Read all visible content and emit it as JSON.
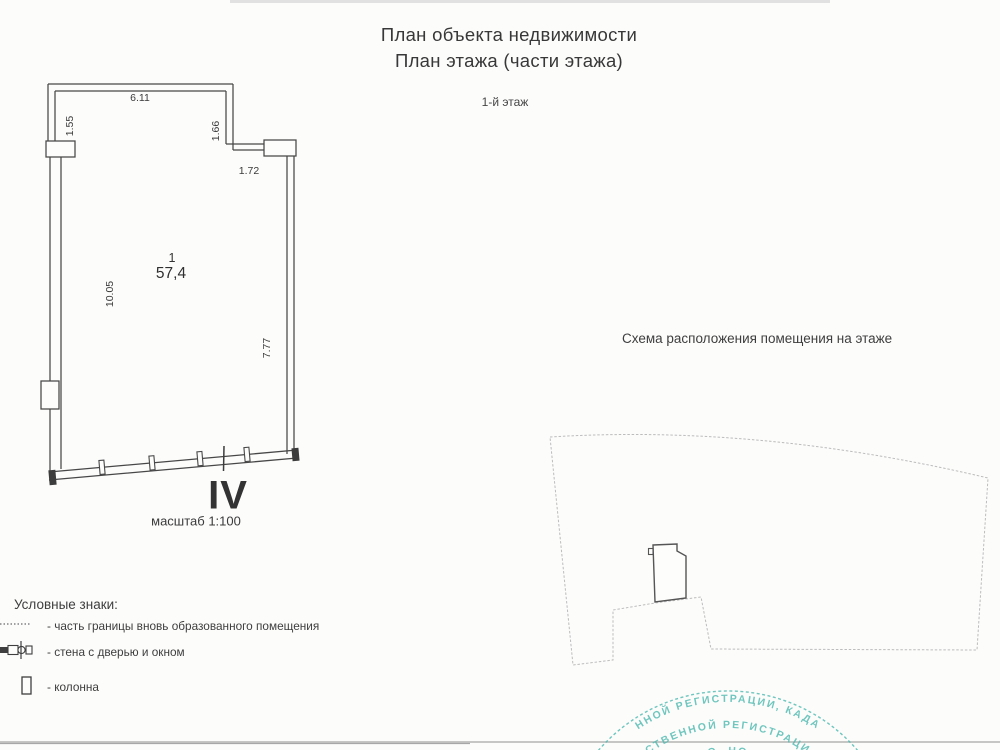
{
  "header": {
    "title_line1": "План объекта недвижимости",
    "title_line2": "План этажа (части этажа)",
    "floor_label": "1-й этаж"
  },
  "floor_plan": {
    "room_number": "1",
    "room_area": "57,4",
    "section_mark": "IV",
    "scale_label": "масштаб 1:100",
    "dimensions": {
      "top_width": "6.11",
      "left_upper": "1.55",
      "notch_height": "1.66",
      "notch_width": "1.72",
      "left_height": "10.05",
      "right_height": "7.77"
    }
  },
  "scheme": {
    "title": "Схема расположения помещения на этаже"
  },
  "legend": {
    "title": "Условные знаки:",
    "items": [
      {
        "symbol": "dashed-boundary-line",
        "label": "- часть границы вновь образованного помещения"
      },
      {
        "symbol": "wall-with-door-and-window",
        "label": "- стена с дверью и окном"
      },
      {
        "symbol": "column",
        "label": "- колонна"
      }
    ]
  },
  "stamp": {
    "color": "#4db9af",
    "ring_text_outer": "ННОЙ РЕГИСТРАЦИИ, КАДА",
    "ring_text_inner": "СТВЕННОЙ РЕГИСТРАЦИ",
    "ring_text_bottom": "О. НО"
  }
}
